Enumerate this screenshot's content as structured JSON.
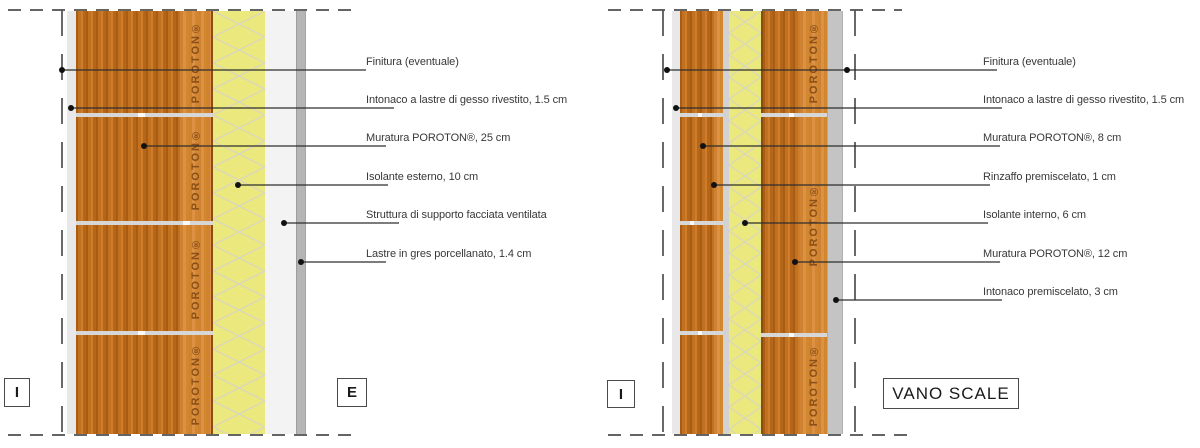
{
  "brand": "POROTON®",
  "left": {
    "labels": [
      "Finitura (eventuale)",
      "Intonaco a lastre di gesso rivestito, 1.5 cm",
      "Muratura POROTON®, 25 cm",
      "Isolante esterno, 10 cm",
      "Struttura di supporto facciata ventilata",
      "Lastre in gres porcellanato, 1.4 cm"
    ],
    "marker_interior": "I",
    "marker_exterior": "E"
  },
  "right": {
    "labels": [
      "Finitura (eventuale)",
      "Intonaco a lastre di gesso rivestito, 1.5 cm",
      "Muratura POROTON®, 8 cm",
      "Rinzaffo premiscelato, 1 cm",
      "Isolante interno, 6 cm",
      "Muratura POROTON®, 12 cm",
      "Intonaco premiscelato, 3 cm"
    ],
    "marker_interior": "I",
    "marker_room": "VANO SCALE"
  },
  "colors": {
    "masonry_orange": "#c27121",
    "masonry_band_orange": "#d98f3f",
    "insulation_yellow": "#ebe87d",
    "plaster_gray": "#e8e8e8",
    "slab_gray": "#b5b5b5",
    "line_dark": "#4f4f4f"
  }
}
